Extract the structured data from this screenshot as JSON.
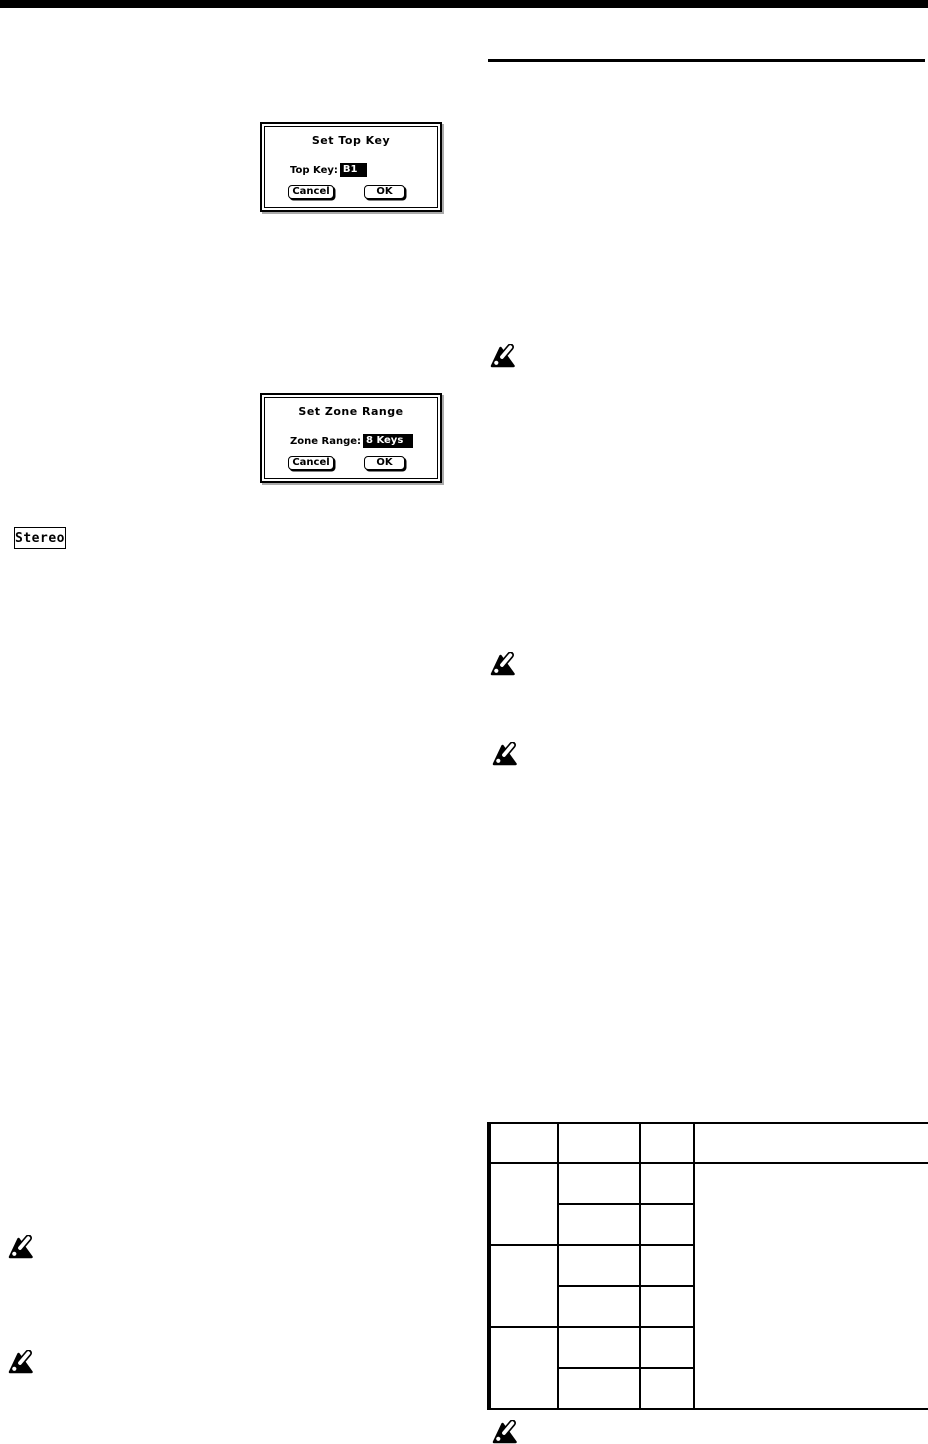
{
  "page": {
    "background": "#ffffff",
    "ink": "#000000"
  },
  "dialogs": {
    "set_top_key": {
      "title": "Set Top Key",
      "field_label": "Top Key:",
      "field_value": "B1",
      "cancel_label": "Cancel",
      "ok_label": "OK"
    },
    "set_zone_range": {
      "title": "Set Zone Range",
      "field_label": "Zone Range:",
      "field_value": "8 Keys",
      "cancel_label": "Cancel",
      "ok_label": "OK"
    }
  },
  "stereo_button": {
    "label": "Stereo"
  },
  "icons": {
    "note_marker_count": 6,
    "note_marker_meaning": "korg-note-marker"
  },
  "table": {
    "columns": 4,
    "header_cells": [
      "",
      "",
      "",
      ""
    ],
    "body": {
      "groups": 3,
      "subrows_per_group": 2,
      "cells_empty": true
    }
  }
}
